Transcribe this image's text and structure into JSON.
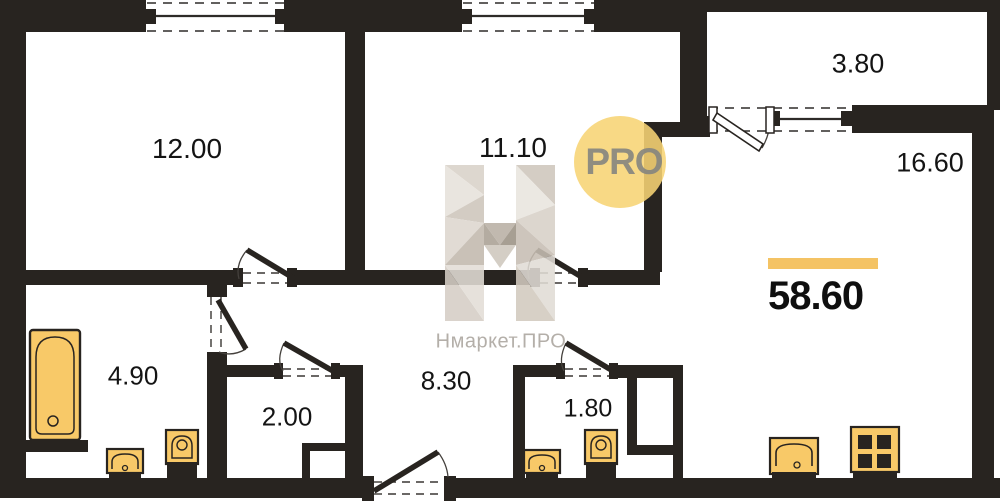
{
  "plan": {
    "total_area": "58.60",
    "rooms": [
      {
        "id": "room-1",
        "area": "12.00"
      },
      {
        "id": "room-2",
        "area": "11.10"
      },
      {
        "id": "balcony",
        "area": "3.80"
      },
      {
        "id": "kitchen-living",
        "area": "16.60"
      },
      {
        "id": "bathroom",
        "area": "4.90"
      },
      {
        "id": "storage",
        "area": "2.00"
      },
      {
        "id": "hallway",
        "area": "8.30"
      },
      {
        "id": "wc",
        "area": "1.80"
      }
    ],
    "fixtures": [
      "bathtub",
      "sink",
      "toilet",
      "sink",
      "toilet",
      "kitchen-sink",
      "stove"
    ]
  },
  "branding": {
    "badge_text": "PRO",
    "watermark_text": "Нмаркет.ПРО"
  },
  "colors": {
    "wall": "#282420",
    "fixture_fill": "#f8c968",
    "accent_bar": "#f4c364",
    "badge_bg": "#f7d474",
    "badge_text": "#848480",
    "watermark_gray": "#b4afa9"
  }
}
